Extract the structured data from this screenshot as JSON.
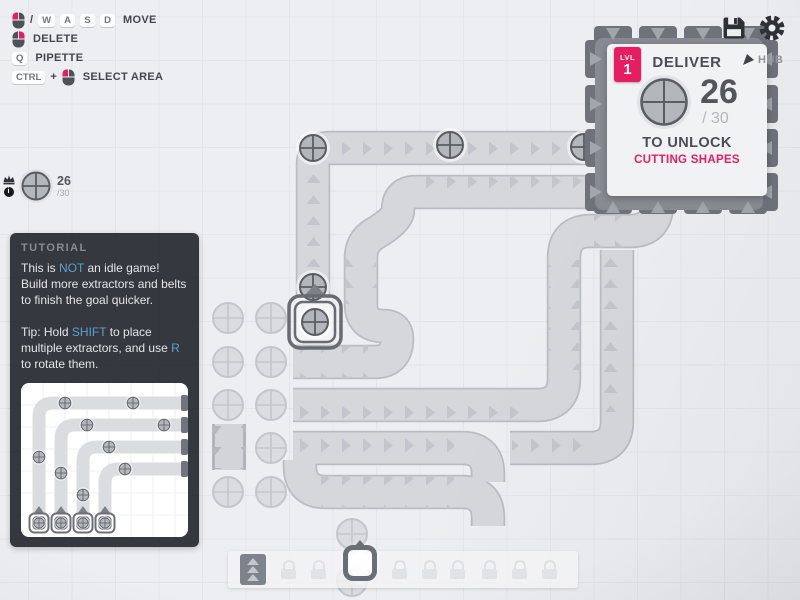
{
  "colors": {
    "accent_pink": "#e81d61",
    "hint_blue": "#5ca0d0",
    "belt_fill": "#d5d7db",
    "hub_dark": "#6f727a"
  },
  "keybinds": {
    "slash": "/",
    "move": {
      "keys": [
        "W",
        "A",
        "S",
        "D"
      ],
      "label": "MOVE"
    },
    "delete": {
      "label": "DELETE"
    },
    "pipette": {
      "key": "Q",
      "label": "PIPETTE"
    },
    "select_area": {
      "key": "CTRL",
      "plus": "+",
      "label": "SELECT AREA"
    }
  },
  "pinned_goal": {
    "count": "26",
    "total": "/30"
  },
  "hub_marker": {
    "label": "HUB"
  },
  "hub_panel": {
    "level_label": "LVL",
    "level": "1",
    "title": "DELIVER",
    "count": "26",
    "total": "/ 30",
    "unlock_label": "TO UNLOCK",
    "reward": "CUTTING SHAPES"
  },
  "tutorial": {
    "title": "TUTORIAL",
    "p1_a": "This is ",
    "p1_b": "NOT",
    "p1_c": " an idle game! Build more extractors and belts to finish the goal quicker.",
    "p2_a": "Tip: Hold ",
    "p2_b": "SHIFT",
    "p2_c": " to place multiple extractors, and use ",
    "p2_d": "R",
    "p2_e": " to rotate them."
  },
  "toolbar": {
    "slots": [
      "belt",
      "locked",
      "locked",
      "extractor",
      "locked",
      "locked",
      "locked",
      "locked",
      "locked",
      "locked"
    ],
    "selected": "extractor"
  }
}
